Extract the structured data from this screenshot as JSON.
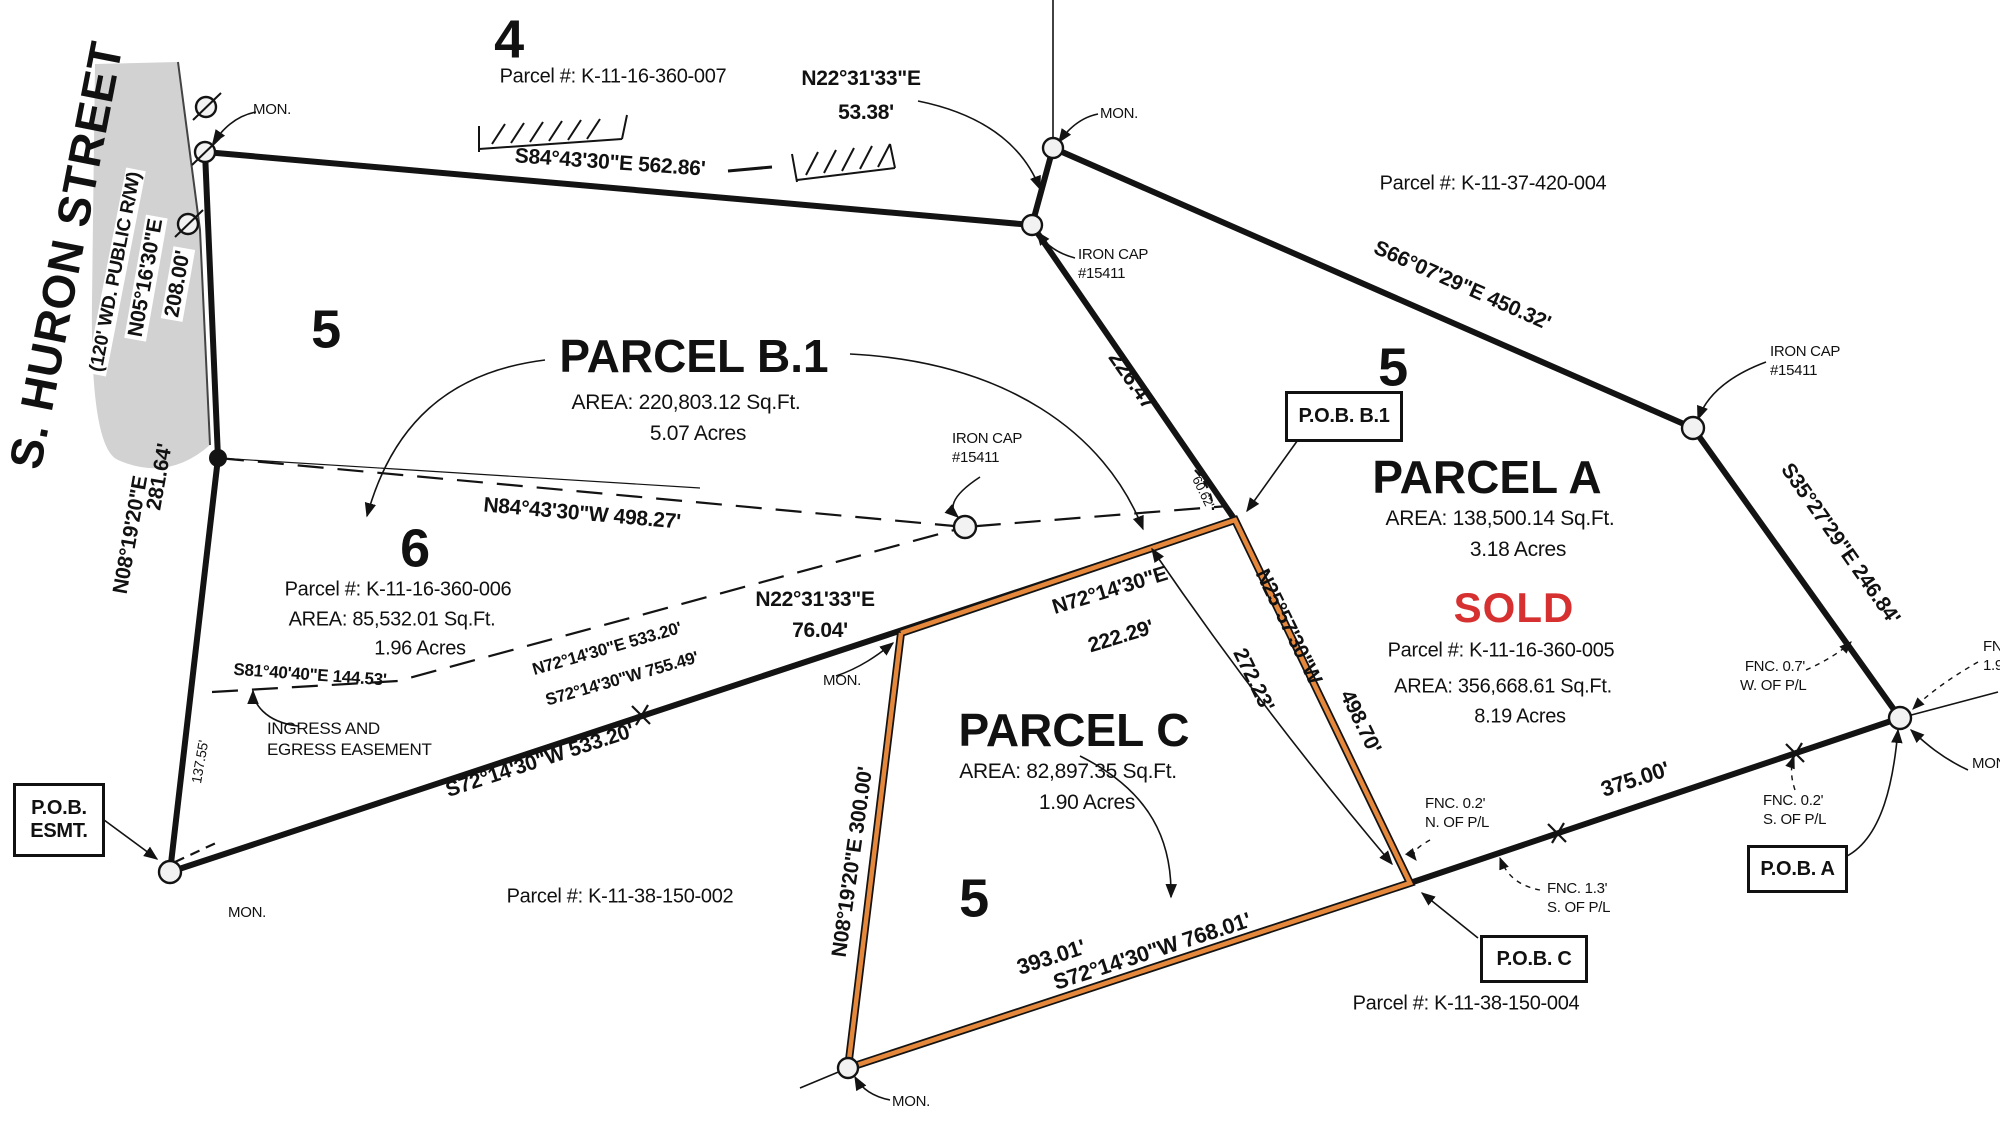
{
  "street": {
    "name": "S. HURON STREET",
    "row_note": "(120' WD. PUBLIC R/W)"
  },
  "sections": {
    "s4": "4",
    "s5_left": "5",
    "s6": "6",
    "s5_right": "5",
    "s5_bottom": "5"
  },
  "parcel_b1": {
    "title": "PARCEL B.1",
    "area": "AREA: 220,803.12 Sq.Ft.",
    "acres": "5.07 Acres"
  },
  "parcel_a": {
    "title": "PARCEL A",
    "area": "AREA: 138,500.14 Sq.Ft.",
    "acres": "3.18 Acres",
    "status": "SOLD",
    "parcel_no": "Parcel #: K-11-16-360-005",
    "total_area": "AREA: 356,668.61 Sq.Ft.",
    "total_acres": "8.19 Acres"
  },
  "parcel_c": {
    "title": "PARCEL C",
    "area": "AREA: 82,897.35 Sq.Ft.",
    "acres": "1.90 Acres"
  },
  "parcel_6": {
    "parcel_no": "Parcel #: K-11-16-360-006",
    "area": "AREA: 85,532.01 Sq.Ft.",
    "acres": "1.96 Acres"
  },
  "parcel_nos": {
    "north": "Parcel #: K-11-16-360-007",
    "northeast": "Parcel #: K-11-37-420-004",
    "southwest": "Parcel #: K-11-38-150-002",
    "south": "Parcel #: K-11-38-150-004"
  },
  "dims": {
    "top": "S84°43'30\"E  562.86'",
    "tie_brg": "N22°31'33\"E",
    "tie_dist": "53.38'",
    "ne": "S66°07'29\"E  450.32'",
    "east": "S35°27'29\"E  246.84'",
    "left_up_brg": "N05°16'30\"E",
    "left_up_dist": "208.00'",
    "left_lo_brg": "N08°19'20\"E",
    "left_lo_dist": "281.64'",
    "left_part": "137.55'",
    "esmt_s81": "S81°40'40\"E  144.53'",
    "esmt_n72": "N72°14'30\"E  533.20'",
    "sw_755": "S72°14'30\"W  755.49'",
    "sw_533": "S72°14'30\"W  533.20'",
    "dash_n84": "N84°43'30\"W  498.27'",
    "mid_brg": "N22°31'33\"E",
    "mid_dist": "76.04'",
    "c_top_brg": "N72°14'30\"E",
    "c_top_dist": "222.29'",
    "c_left": "N08°19'20\"E  300.00'",
    "c_right_brg": "N25°57'30\"W",
    "c_right_dist": "498.70'",
    "c_right_part": "272.23'",
    "seg_226": "226.47'",
    "seg_60": "60.62'",
    "seg_375": "375.00'",
    "seg_393": "393.01'",
    "s_total": "S72°14'30\"W  768.01'"
  },
  "pob": {
    "esmt_1": "P.O.B.",
    "esmt_2": "ESMT.",
    "b1": "P.O.B. B.1",
    "a": "P.O.B. A",
    "c": "P.O.B. C"
  },
  "notes": {
    "mon": "MON.",
    "iron_cap_1": "IRON CAP",
    "iron_cap_2": "#15411",
    "ingress_1": "INGRESS AND",
    "ingress_2": "EGRESS EASEMENT",
    "fnc07_1": "FNC. 0.7'",
    "fnc07_2": "W. OF P/L",
    "fnc02n_1": "FNC. 0.2'",
    "fnc02n_2": "N. OF P/L",
    "fnc02s_1": "FNC. 0.2'",
    "fnc02s_2": "S. OF P/L",
    "fnc13_1": "FNC. 1.3'",
    "fnc13_2": "S. OF P/L",
    "fnc_cut_1": "FNC",
    "fnc_cut_2": "1.9",
    "mon_cut": "MON."
  },
  "colors": {
    "highlight_orange": "#E5883C",
    "sold_red": "#D63030",
    "street_gray": "#D2D2D2",
    "line_black": "#131313"
  }
}
